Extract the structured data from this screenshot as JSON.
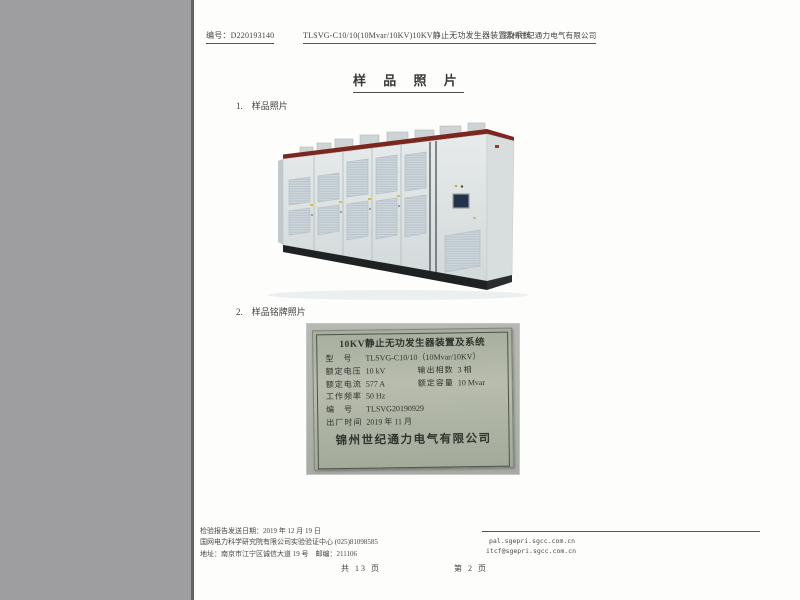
{
  "header": {
    "report_no": "编号：D220193140",
    "doc_title": "TLSVG-C10/10(10Mvar/10KV)10KV静止无功发生器装置及系统",
    "company": "锦州世纪通力电气有限公司"
  },
  "title": "样 品 照 片",
  "sections": {
    "item1": "1.　样品照片",
    "item2": "2.　样品铭牌照片"
  },
  "nameplate": {
    "title": "10KV静止无功发生器装置及系统",
    "model_label": "型　号",
    "model_value": "TLSVG-C10/10（10Mvar/10KV）",
    "voltage_label": "额定电压",
    "voltage_value": "10 kV",
    "phases_label": "输出相数",
    "phases_value": "3 相",
    "current_label": "额定电流",
    "current_value": "577 A",
    "capacity_label": "额定容量",
    "capacity_value": "10 Mvar",
    "freq_label": "工作频率",
    "freq_value": "50 Hz",
    "serial_label": "编　号",
    "serial_value": "TLSVG20190929",
    "date_label": "出厂时间",
    "date_value": "2019 年 11 月",
    "company": "锦州世纪通力电气有限公司"
  },
  "footer": {
    "send_date": "检验报告发送日期：2019 年 12 月 19 日",
    "org": "国网电力科学研究院有限公司实验验证中心 (025)81098585",
    "address": "地址：南京市江宁区诚信大道 19 号　邮编：211106",
    "web": "pal.sgepri.sgcc.com.cn",
    "email": "itcf@sgepri.sgcc.com.cn",
    "page_total": "共 13 页",
    "page_current": "第 2 页"
  },
  "colors": {
    "scanner_margin": "#9e9ea0",
    "cabinet_top_stripe": "#7c2620",
    "nameplate_plate": "#aab09f",
    "nameplate_photo_bg": "#b2b4af"
  }
}
